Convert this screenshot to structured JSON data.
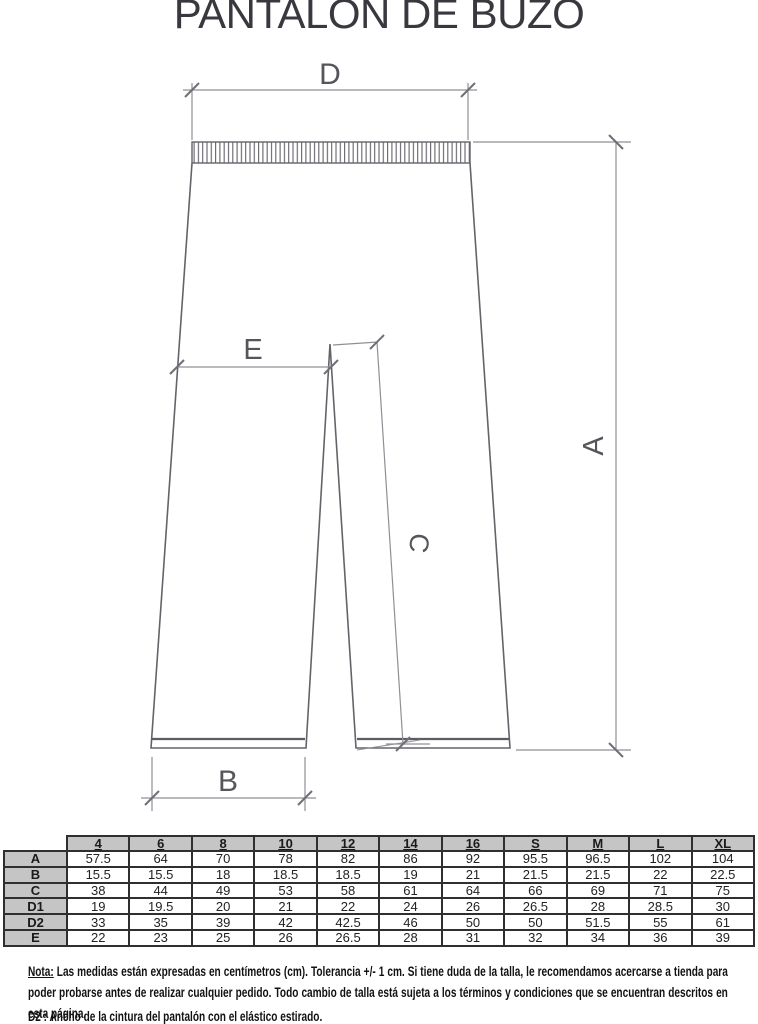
{
  "title": "PANTALON DE BUZO",
  "diagram": {
    "labels": {
      "d": "D",
      "a": "A",
      "b": "B",
      "c": "C",
      "e": "E"
    }
  },
  "table": {
    "corner": "",
    "sizes": [
      "4",
      "6",
      "8",
      "10",
      "12",
      "14",
      "16",
      "S",
      "M",
      "L",
      "XL"
    ],
    "rows": [
      {
        "label": "A",
        "values": [
          "57.5",
          "64",
          "70",
          "78",
          "82",
          "86",
          "92",
          "95.5",
          "96.5",
          "102",
          "104"
        ]
      },
      {
        "label": "B",
        "values": [
          "15.5",
          "15.5",
          "18",
          "18.5",
          "18.5",
          "19",
          "21",
          "21.5",
          "21.5",
          "22",
          "22.5"
        ]
      },
      {
        "label": "C",
        "values": [
          "38",
          "44",
          "49",
          "53",
          "58",
          "61",
          "64",
          "66",
          "69",
          "71",
          "75"
        ]
      },
      {
        "label": "D1",
        "values": [
          "19",
          "19.5",
          "20",
          "21",
          "22",
          "24",
          "26",
          "26.5",
          "28",
          "28.5",
          "30"
        ]
      },
      {
        "label": "D2",
        "values": [
          "33",
          "35",
          "39",
          "42",
          "42.5",
          "46",
          "50",
          "50",
          "51.5",
          "55",
          "61"
        ]
      },
      {
        "label": "E",
        "values": [
          "22",
          "23",
          "25",
          "26",
          "26.5",
          "28",
          "31",
          "32",
          "34",
          "36",
          "39"
        ]
      }
    ]
  },
  "notes": {
    "nota_label": "Nota:",
    "nota_text": " Las medidas están expresadas en centímetros (cm). Tolerancia +/- 1 cm. Si tiene duda de la talla, le recomendamos acercarse a tienda para poder probarse antes de realizar cualquier pedido. Todo cambio de talla está sujeta a los términos y condiciones que se encuentran descritos en esta página.",
    "d2_note": "D2 : Ancho de la cintura del pantalón con el elástico estirado."
  },
  "colors": {
    "outline": "#63636a",
    "dimension": "#8f8f96",
    "table_header_bg": "#c5c5c5",
    "table_border": "#2f2f2f",
    "title_text": "#38383e"
  }
}
